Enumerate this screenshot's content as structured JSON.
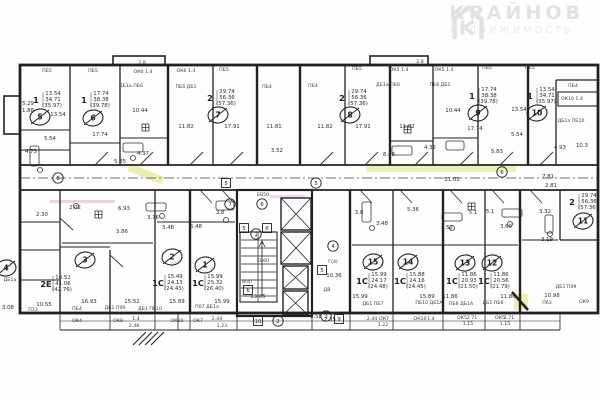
{
  "logo": {
    "icon": "house-k-icon",
    "title": "КРАЙНОВ",
    "subtitle": "НЕДВИЖИМОСТЬ"
  },
  "colors": {
    "ink": "#262626",
    "paper": "#fefefe",
    "highlight": "#d8e06e",
    "pink": "#dd8fd0",
    "logo": "#e4e4e4"
  },
  "plan": {
    "apartments": [
      {
        "num": "5",
        "type": "1",
        "areas": [
          "13.54",
          "34.71",
          "(35.97)"
        ],
        "cx": 40,
        "cy": 117,
        "tx": 34,
        "ty": 100
      },
      {
        "num": "6",
        "type": "1",
        "areas": [
          "17.74",
          "38.38",
          "(39.78)"
        ],
        "cx": 93,
        "cy": 118,
        "tx": 82,
        "ty": 100
      },
      {
        "num": "7",
        "type": "2",
        "areas": [
          "29.74",
          "56.36",
          "(57.36)"
        ],
        "cx": 218,
        "cy": 115,
        "tx": 208,
        "ty": 98
      },
      {
        "num": "8",
        "type": "2",
        "areas": [
          "29.74",
          "56.36",
          "(57.36)"
        ],
        "cx": 350,
        "cy": 115,
        "tx": 340,
        "ty": 98
      },
      {
        "num": "9",
        "type": "1",
        "areas": [
          "17.74",
          "38.38",
          "(39.78)"
        ],
        "cx": 478,
        "cy": 113,
        "tx": 470,
        "ty": 96
      },
      {
        "num": "10",
        "type": "1",
        "areas": [
          "13.54",
          "34.71",
          "(35.97)"
        ],
        "cx": 537,
        "cy": 113,
        "tx": 528,
        "ty": 96
      },
      {
        "num": "11",
        "type": "2",
        "areas": [
          "29.74",
          "56.36",
          "(57.36)"
        ],
        "cx": 583,
        "cy": 221,
        "tx": 570,
        "ty": 202
      },
      {
        "num": "3",
        "type": "2Е",
        "areas": [
          "13.52",
          "41.06",
          "(42.76)"
        ],
        "cx": 85,
        "cy": 260,
        "tx": 44,
        "ty": 284
      },
      {
        "num": "2",
        "type": "1С",
        "areas": [
          "15.49",
          "24.13",
          "(24.43)"
        ],
        "cx": 172,
        "cy": 257,
        "tx": 156,
        "ty": 283
      },
      {
        "num": "1",
        "type": "1С",
        "areas": [
          "15.99",
          "25.32",
          "(26.40)"
        ],
        "cx": 205,
        "cy": 265,
        "tx": 196,
        "ty": 283
      },
      {
        "num": "15",
        "type": "1С",
        "areas": [
          "15.99",
          "24.17",
          "(24.48)"
        ],
        "cx": 373,
        "cy": 262,
        "tx": 360,
        "ty": 281
      },
      {
        "num": "14",
        "type": "1С",
        "areas": [
          "15.88",
          "24.16",
          "(24.45)"
        ],
        "cx": 408,
        "cy": 262,
        "tx": 398,
        "ty": 281
      },
      {
        "num": "13",
        "type": "1С",
        "areas": [
          "11.86",
          "20.93",
          "(21.50)"
        ],
        "cx": 465,
        "cy": 263,
        "tx": 450,
        "ty": 281
      },
      {
        "num": "12",
        "type": "1С",
        "areas": [
          "11.86",
          "20.56",
          "(21.79)"
        ],
        "cx": 492,
        "cy": 263,
        "tx": 482,
        "ty": 281
      },
      {
        "num": "4",
        "type": "",
        "areas": [],
        "cx": 6,
        "cy": 268,
        "tx": 0,
        "ty": 0
      }
    ],
    "dimensions": [
      [
        "13.54",
        58,
        116
      ],
      [
        "17.74",
        100,
        136
      ],
      [
        "5.54",
        50,
        140
      ],
      [
        "4.73",
        31,
        153
      ],
      [
        "10.44",
        140,
        112
      ],
      [
        "5.85",
        120,
        163
      ],
      [
        "4.37",
        143,
        155
      ],
      [
        "11.82",
        186,
        128
      ],
      [
        "17.91",
        232,
        128
      ],
      [
        "11.81",
        274,
        128
      ],
      [
        "3.52",
        277,
        152
      ],
      [
        "8.68",
        389,
        156
      ],
      [
        "11.82",
        325,
        128
      ],
      [
        "17.91",
        363,
        128
      ],
      [
        "11.82",
        407,
        128
      ],
      [
        "10.44",
        453,
        112
      ],
      [
        "4.32",
        430,
        149
      ],
      [
        "17.74",
        475,
        130
      ],
      [
        "13.54",
        519,
        111
      ],
      [
        "5.54",
        517,
        136
      ],
      [
        "5.83",
        497,
        153
      ],
      [
        "4.93",
        560,
        149
      ],
      [
        "10.3",
        582,
        147
      ],
      [
        "7.81",
        548,
        178
      ],
      [
        "2.81",
        551,
        187
      ],
      [
        "51.01",
        452,
        181
      ],
      [
        "5.29",
        28,
        105
      ],
      [
        "1.88",
        28,
        112
      ],
      [
        "2.30",
        42,
        216
      ],
      [
        "3.08",
        8,
        309
      ],
      [
        "10.55",
        44,
        306
      ],
      [
        "2.02",
        75,
        209
      ],
      [
        "6.93",
        124,
        210
      ],
      [
        "3.86",
        122,
        233
      ],
      [
        "3.76",
        153,
        219
      ],
      [
        "3.48",
        168,
        229
      ],
      [
        "5.48",
        196,
        228
      ],
      [
        "3.8",
        220,
        214
      ],
      [
        "16.93",
        89,
        303
      ],
      [
        "15.52",
        132,
        303
      ],
      [
        "15.89",
        177,
        303
      ],
      [
        "15.99",
        222,
        303
      ],
      [
        "13.05",
        258,
        298
      ],
      [
        "10.36",
        334,
        277
      ],
      [
        "15.99",
        360,
        298
      ],
      [
        "15.89",
        427,
        298
      ],
      [
        "11.86",
        450,
        298
      ],
      [
        "11.86",
        508,
        298
      ],
      [
        "10.98",
        552,
        297
      ],
      [
        "8.58",
        316,
        318
      ],
      [
        "2.35",
        330,
        321
      ],
      [
        "3.8",
        359,
        214
      ],
      [
        "3.48",
        382,
        225
      ],
      [
        "5.36",
        413,
        211
      ],
      [
        "3.52",
        447,
        229
      ],
      [
        "5.1",
        473,
        214
      ],
      [
        "5.1",
        490,
        213
      ],
      [
        "3.60",
        506,
        228
      ],
      [
        "3.32",
        545,
        213
      ],
      [
        "3.19",
        547,
        241
      ]
    ],
    "wall_labels": [
      [
        "ПБ5",
        47,
        72
      ],
      [
        "ПБ5",
        93,
        72
      ],
      [
        "ПБ5",
        224,
        71
      ],
      [
        "ПБ5",
        357,
        70
      ],
      [
        "ПБ5",
        487,
        69
      ],
      [
        "ПБ5",
        530,
        69
      ],
      [
        "ОК6 1.4",
        143,
        73
      ],
      [
        "ОК6 1.4",
        186,
        72
      ],
      [
        "ОК5 1.4",
        399,
        71
      ],
      [
        "ОК5 1.4",
        444,
        71
      ],
      [
        "ДБ1а ПБ6",
        131,
        87
      ],
      [
        "ПБ6 ДБ1",
        186,
        88
      ],
      [
        "ДБ1а ПБ6",
        388,
        86
      ],
      [
        "ПБ6 ДБ1",
        440,
        86
      ],
      [
        "ПБ4",
        267,
        88
      ],
      [
        "ПБ4",
        313,
        87
      ],
      [
        "ПБ4",
        573,
        87
      ],
      [
        "2.8",
        142,
        64
      ],
      [
        "2.8",
        420,
        63
      ],
      [
        "ОК10 1.4",
        572,
        100
      ],
      [
        "ДБ1а ПБ10",
        571,
        122
      ],
      [
        "ПБ4",
        77,
        310
      ],
      [
        "ДБ1 П09",
        115,
        309
      ],
      [
        "ДБ1 ПБ10",
        150,
        310
      ],
      [
        "П07 ДБ1а",
        207,
        308
      ],
      [
        "ДБ1 ПБ7",
        373,
        305
      ],
      [
        "ПБ10 ДБ1А",
        429,
        304
      ],
      [
        "ПБ6 ДБ1А",
        461,
        305
      ],
      [
        "ДБ1 ПБ6",
        493,
        304
      ],
      [
        "П13",
        33,
        311
      ],
      [
        "ДБ1а",
        10,
        281
      ],
      [
        "ОК4",
        77,
        322
      ],
      [
        "ОК8",
        118,
        322
      ],
      [
        "1.4",
        136,
        320
      ],
      [
        "2.48",
        134,
        327
      ],
      [
        "ОК10",
        177,
        322
      ],
      [
        "ОК7",
        198,
        322
      ],
      [
        "2.44",
        217,
        320
      ],
      [
        "1.23",
        222,
        327
      ],
      [
        "2.44",
        372,
        320
      ],
      [
        "ОК7",
        384,
        320
      ],
      [
        "1.22",
        383,
        326
      ],
      [
        "ОК10",
        420,
        320
      ],
      [
        "1.4",
        431,
        320
      ],
      [
        "ОК5",
        462,
        319
      ],
      [
        "2.71",
        472,
        319
      ],
      [
        "1.15",
        468,
        325
      ],
      [
        "ОК5",
        500,
        319
      ],
      [
        "2.71",
        509,
        319
      ],
      [
        "1.15",
        505,
        325
      ],
      [
        "ОК9",
        584,
        303
      ],
      [
        "П63",
        547,
        304
      ],
      [
        "ДБ1 П09",
        566,
        288
      ],
      [
        "ЕВ50",
        263,
        196
      ],
      [
        "ЕВ60",
        263,
        262
      ],
      [
        "Г(4)",
        333,
        263
      ],
      [
        "ДВ",
        327,
        291
      ],
      [
        "В(4)",
        247,
        283
      ]
    ],
    "badges": [
      {
        "t": "5",
        "x": 244,
        "y": 228,
        "shape": "square"
      },
      {
        "t": "6",
        "x": 267,
        "y": 228,
        "shape": "square"
      },
      {
        "t": "5",
        "x": 322,
        "y": 270,
        "shape": "square"
      },
      {
        "t": "6",
        "x": 248,
        "y": 290,
        "shape": "square"
      },
      {
        "t": "9",
        "x": 339,
        "y": 319,
        "shape": "square"
      },
      {
        "t": "10",
        "x": 258,
        "y": 321,
        "shape": "square"
      },
      {
        "t": "5",
        "x": 226,
        "y": 183,
        "shape": "square"
      },
      {
        "t": "8",
        "x": 58,
        "y": 178,
        "shape": "circle"
      },
      {
        "t": "5",
        "x": 316,
        "y": 183,
        "shape": "circle"
      },
      {
        "t": "6",
        "x": 502,
        "y": 172,
        "shape": "circle"
      },
      {
        "t": "7",
        "x": 230,
        "y": 204,
        "shape": "circle"
      },
      {
        "t": "6",
        "x": 262,
        "y": 204,
        "shape": "circle"
      },
      {
        "t": "1",
        "x": 256,
        "y": 234,
        "shape": "circle"
      },
      {
        "t": "4",
        "x": 333,
        "y": 246,
        "shape": "circle"
      },
      {
        "t": "2",
        "x": 278,
        "y": 321,
        "shape": "circle"
      },
      {
        "t": "3",
        "x": 326,
        "y": 316,
        "shape": "circle"
      }
    ]
  }
}
